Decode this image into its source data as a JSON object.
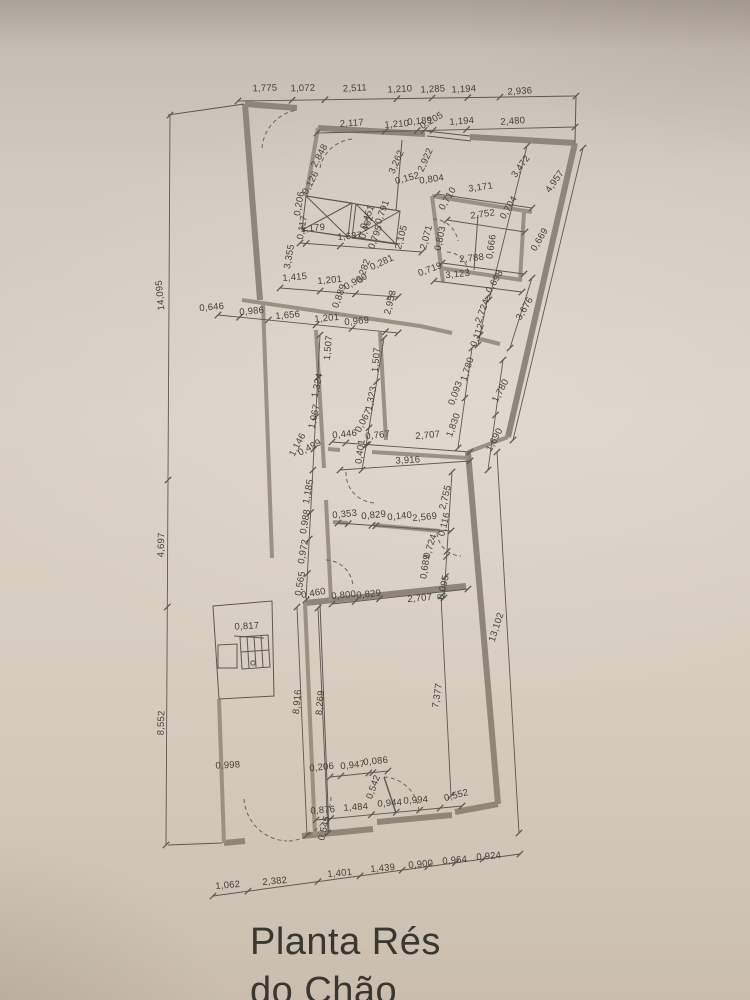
{
  "document": {
    "kind": "architectural-floor-plan-photo",
    "title_line1": "Planta Rés",
    "title_line2": "do Chão"
  },
  "colors": {
    "paper": "#d8d0c3",
    "ink": "#45413b",
    "wall": "#8e8678"
  },
  "dimension_labels": [
    {
      "t": "1,775",
      "x": 265,
      "y": 91,
      "r": -2
    },
    {
      "t": "1,072",
      "x": 303,
      "y": 91,
      "r": -2
    },
    {
      "t": "2,511",
      "x": 355,
      "y": 91,
      "r": -3
    },
    {
      "t": "1,210",
      "x": 400,
      "y": 92,
      "r": -3
    },
    {
      "t": "1,285",
      "x": 433,
      "y": 92,
      "r": -3
    },
    {
      "t": "1,194",
      "x": 464,
      "y": 92,
      "r": -3
    },
    {
      "t": "2,936",
      "x": 520,
      "y": 94,
      "r": -3
    },
    {
      "t": "2,117",
      "x": 352,
      "y": 126,
      "r": -4
    },
    {
      "t": "1,210",
      "x": 397,
      "y": 127,
      "r": -4
    },
    {
      "t": "0,189",
      "x": 420,
      "y": 124,
      "r": -5
    },
    {
      "t": "0,205",
      "x": 433,
      "y": 123,
      "r": -30
    },
    {
      "t": "1,194",
      "x": 462,
      "y": 124,
      "r": -4
    },
    {
      "t": "2,480",
      "x": 513,
      "y": 124,
      "r": -4
    },
    {
      "t": "2,848",
      "x": 322,
      "y": 157,
      "r": -62
    },
    {
      "t": "0,126",
      "x": 313,
      "y": 184,
      "r": -62
    },
    {
      "t": "3,262",
      "x": 399,
      "y": 163,
      "r": -66
    },
    {
      "t": "2,922",
      "x": 428,
      "y": 161,
      "r": -66
    },
    {
      "t": "0,152",
      "x": 408,
      "y": 181,
      "r": -15
    },
    {
      "t": "0,804",
      "x": 432,
      "y": 182,
      "r": -8
    },
    {
      "t": "3,472",
      "x": 523,
      "y": 168,
      "r": -55
    },
    {
      "t": "4,957",
      "x": 557,
      "y": 183,
      "r": -55
    },
    {
      "t": "0,206",
      "x": 302,
      "y": 204,
      "r": -80
    },
    {
      "t": "0,117",
      "x": 305,
      "y": 228,
      "r": -80
    },
    {
      "t": "1,179",
      "x": 313,
      "y": 231,
      "r": -5
    },
    {
      "t": "1,637",
      "x": 350,
      "y": 239,
      "r": -5
    },
    {
      "t": "0,451",
      "x": 370,
      "y": 218,
      "r": -70
    },
    {
      "t": "0,462",
      "x": 369,
      "y": 228,
      "r": -70
    },
    {
      "t": "0,791",
      "x": 385,
      "y": 213,
      "r": -70
    },
    {
      "t": "0,795",
      "x": 378,
      "y": 238,
      "r": -70
    },
    {
      "t": "2,105",
      "x": 404,
      "y": 238,
      "r": -75
    },
    {
      "t": "2,071",
      "x": 429,
      "y": 238,
      "r": -75
    },
    {
      "t": "0,710",
      "x": 450,
      "y": 200,
      "r": -60
    },
    {
      "t": "3,171",
      "x": 481,
      "y": 190,
      "r": -8
    },
    {
      "t": "2,752",
      "x": 483,
      "y": 217,
      "r": -8
    },
    {
      "t": "0,704",
      "x": 511,
      "y": 209,
      "r": -60
    },
    {
      "t": "0,803",
      "x": 443,
      "y": 239,
      "r": -78
    },
    {
      "t": "0,666",
      "x": 494,
      "y": 247,
      "r": -82
    },
    {
      "t": "0,669",
      "x": 542,
      "y": 241,
      "r": -60
    },
    {
      "t": "2,788",
      "x": 472,
      "y": 261,
      "r": -6
    },
    {
      "t": "0,719",
      "x": 431,
      "y": 272,
      "r": -20
    },
    {
      "t": "3,123",
      "x": 458,
      "y": 277,
      "r": -6
    },
    {
      "t": "0,698",
      "x": 497,
      "y": 283,
      "r": -60
    },
    {
      "t": "3,355",
      "x": 292,
      "y": 257,
      "r": -80
    },
    {
      "t": "1,415",
      "x": 295,
      "y": 280,
      "r": -5
    },
    {
      "t": "1,201",
      "x": 330,
      "y": 283,
      "r": -5
    },
    {
      "t": "0,990",
      "x": 357,
      "y": 284,
      "r": -28
    },
    {
      "t": "0,282",
      "x": 366,
      "y": 272,
      "r": -70
    },
    {
      "t": "0,281",
      "x": 383,
      "y": 265,
      "r": -25
    },
    {
      "t": "0,889",
      "x": 342,
      "y": 297,
      "r": -70
    },
    {
      "t": "2,953",
      "x": 393,
      "y": 303,
      "r": -76
    },
    {
      "t": "0,646",
      "x": 212,
      "y": 310,
      "r": -5
    },
    {
      "t": "0,986",
      "x": 252,
      "y": 314,
      "r": -5
    },
    {
      "t": "1,656",
      "x": 288,
      "y": 318,
      "r": -5
    },
    {
      "t": "1,201",
      "x": 327,
      "y": 321,
      "r": -5
    },
    {
      "t": "0,969",
      "x": 357,
      "y": 324,
      "r": -5
    },
    {
      "t": "14,095",
      "x": 163,
      "y": 295,
      "r": -95
    },
    {
      "t": "4,697",
      "x": 164,
      "y": 545,
      "r": -88
    },
    {
      "t": "8,552",
      "x": 164,
      "y": 723,
      "r": -88
    },
    {
      "t": "2,724",
      "x": 485,
      "y": 312,
      "r": -70
    },
    {
      "t": "0,112",
      "x": 480,
      "y": 336,
      "r": -70
    },
    {
      "t": "3,676",
      "x": 527,
      "y": 310,
      "r": -60
    },
    {
      "t": "1,780",
      "x": 470,
      "y": 370,
      "r": -72
    },
    {
      "t": "1,780",
      "x": 503,
      "y": 392,
      "r": -62
    },
    {
      "t": "1,690",
      "x": 497,
      "y": 441,
      "r": -62
    },
    {
      "t": "0,093",
      "x": 458,
      "y": 394,
      "r": -70
    },
    {
      "t": "1,830",
      "x": 456,
      "y": 426,
      "r": -70
    },
    {
      "t": "1,507",
      "x": 331,
      "y": 348,
      "r": -85
    },
    {
      "t": "1,507",
      "x": 379,
      "y": 360,
      "r": -85
    },
    {
      "t": "1,324",
      "x": 320,
      "y": 386,
      "r": -78
    },
    {
      "t": "1,323",
      "x": 374,
      "y": 399,
      "r": -78
    },
    {
      "t": "1,067",
      "x": 317,
      "y": 417,
      "r": -78
    },
    {
      "t": "0,067",
      "x": 366,
      "y": 422,
      "r": -62
    },
    {
      "t": "1,146",
      "x": 300,
      "y": 446,
      "r": -62
    },
    {
      "t": "0,499",
      "x": 311,
      "y": 450,
      "r": -28
    },
    {
      "t": "1,185",
      "x": 311,
      "y": 492,
      "r": -80
    },
    {
      "t": "0,988",
      "x": 308,
      "y": 522,
      "r": -80
    },
    {
      "t": "0,972",
      "x": 306,
      "y": 552,
      "r": -80
    },
    {
      "t": "0,446",
      "x": 345,
      "y": 437,
      "r": -6
    },
    {
      "t": "0,767",
      "x": 378,
      "y": 438,
      "r": -6
    },
    {
      "t": "2,707",
      "x": 428,
      "y": 438,
      "r": -5
    },
    {
      "t": "0,401",
      "x": 363,
      "y": 452,
      "r": -82
    },
    {
      "t": "3,916",
      "x": 408,
      "y": 463,
      "r": -3
    },
    {
      "t": "0,353",
      "x": 345,
      "y": 517,
      "r": -6
    },
    {
      "t": "0,829",
      "x": 374,
      "y": 518,
      "r": -6
    },
    {
      "t": "0,140",
      "x": 400,
      "y": 519,
      "r": -6
    },
    {
      "t": "2,569",
      "x": 425,
      "y": 520,
      "r": -6
    },
    {
      "t": "2,755",
      "x": 448,
      "y": 498,
      "r": -76
    },
    {
      "t": "0,116",
      "x": 447,
      "y": 525,
      "r": -76
    },
    {
      "t": "0,724",
      "x": 433,
      "y": 547,
      "r": -72
    },
    {
      "t": "0,689",
      "x": 428,
      "y": 567,
      "r": -82
    },
    {
      "t": "0,095",
      "x": 446,
      "y": 588,
      "r": -76
    },
    {
      "t": "0,565",
      "x": 303,
      "y": 584,
      "r": -80
    },
    {
      "t": "0,460",
      "x": 314,
      "y": 596,
      "r": -10
    },
    {
      "t": "0,800",
      "x": 344,
      "y": 598,
      "r": -6
    },
    {
      "t": "0,829",
      "x": 369,
      "y": 597,
      "r": -6
    },
    {
      "t": "2,707",
      "x": 420,
      "y": 601,
      "r": -5
    },
    {
      "t": "13,102",
      "x": 499,
      "y": 628,
      "r": -72
    },
    {
      "t": "0,817",
      "x": 247,
      "y": 629,
      "r": -3
    },
    {
      "t": "8,916",
      "x": 300,
      "y": 702,
      "r": -85
    },
    {
      "t": "8,269",
      "x": 323,
      "y": 703,
      "r": -85
    },
    {
      "t": "7,377",
      "x": 440,
      "y": 696,
      "r": -82
    },
    {
      "t": "0,998",
      "x": 228,
      "y": 768,
      "r": -3
    },
    {
      "t": "0,206",
      "x": 322,
      "y": 770,
      "r": -6
    },
    {
      "t": "0,947",
      "x": 353,
      "y": 768,
      "r": -6
    },
    {
      "t": "0,086",
      "x": 376,
      "y": 764,
      "r": -6
    },
    {
      "t": "0,542",
      "x": 376,
      "y": 788,
      "r": -70
    },
    {
      "t": "0,876",
      "x": 323,
      "y": 813,
      "r": -4
    },
    {
      "t": "1,484",
      "x": 356,
      "y": 810,
      "r": -4
    },
    {
      "t": "0,944",
      "x": 390,
      "y": 806,
      "r": -4
    },
    {
      "t": "0,994",
      "x": 416,
      "y": 803,
      "r": -4
    },
    {
      "t": "0,552",
      "x": 457,
      "y": 798,
      "r": -15
    },
    {
      "t": "0,545",
      "x": 327,
      "y": 829,
      "r": -76
    },
    {
      "t": "1,062",
      "x": 228,
      "y": 888,
      "r": -5
    },
    {
      "t": "2,382",
      "x": 275,
      "y": 884,
      "r": -5
    },
    {
      "t": "1,401",
      "x": 340,
      "y": 876,
      "r": -5
    },
    {
      "t": "1,439",
      "x": 383,
      "y": 871,
      "r": -5
    },
    {
      "t": "0,900",
      "x": 421,
      "y": 867,
      "r": -5
    },
    {
      "t": "0,964",
      "x": 455,
      "y": 863,
      "r": -5
    },
    {
      "t": "0,924",
      "x": 489,
      "y": 859,
      "r": -5
    }
  ]
}
